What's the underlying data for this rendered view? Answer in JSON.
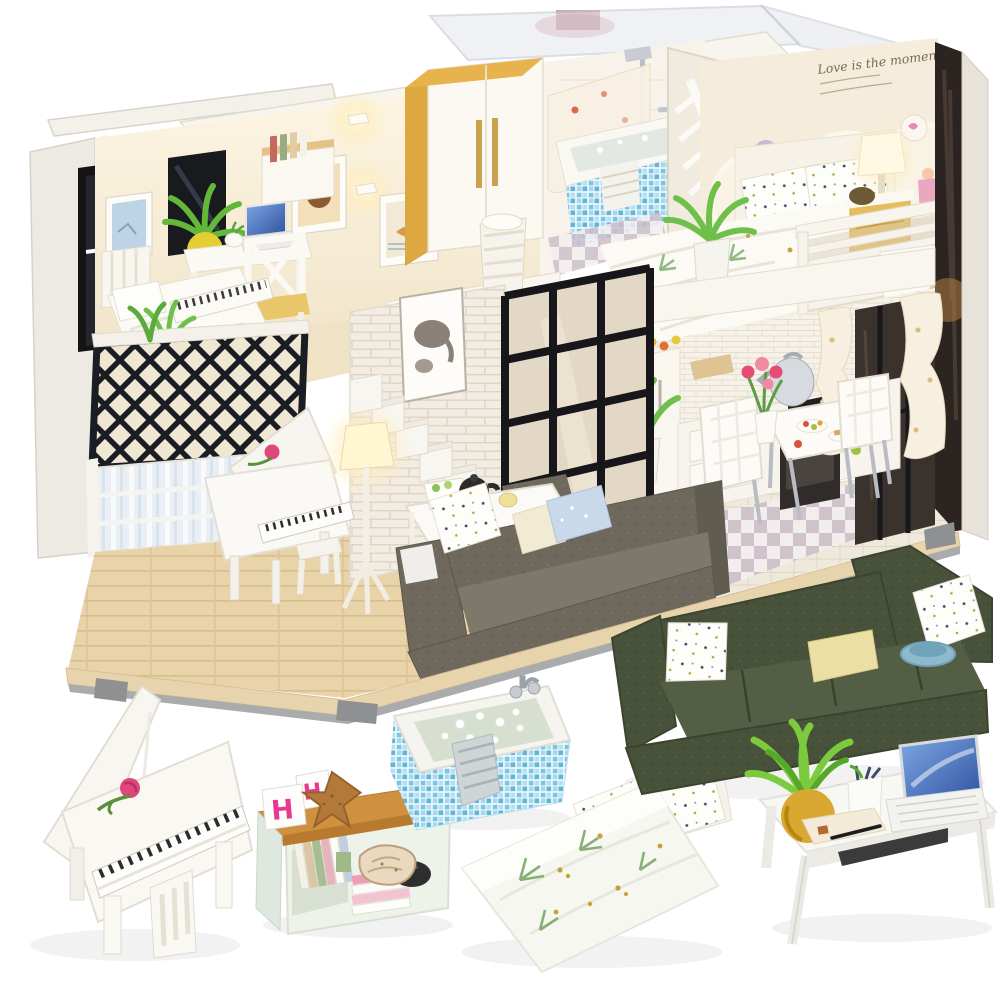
{
  "scene": {
    "type": "product photograph",
    "description": "DIY miniature dollhouse kit - modern two-storey loft with lit LED interior, shown with six close-up miniature furniture pieces on a white background",
    "background_color": "#ffffff"
  },
  "dollhouse": {
    "wall_decal_text": "Love is the moment",
    "style": "open-front modern loft with clear acrylic roof",
    "rooms": [
      {
        "name": "Study bedroom",
        "position": "upper left",
        "items": [
          "single bed",
          "desk with laptop",
          "cross-back chair with yellow seat",
          "wall shelf with books",
          "framed pictures",
          "aloe plant in yellow pot",
          "black lattice balcony railing"
        ]
      },
      {
        "name": "Bathroom",
        "position": "upper centre",
        "items": [
          "blue mosaic bathtub",
          "chrome shower set",
          "floral shower curtain",
          "white-and-gold wardrobe",
          "leaf cut-out screen",
          "towel basket"
        ]
      },
      {
        "name": "Master bedroom",
        "position": "upper right",
        "items": [
          "double bed with botanical duvet",
          "dotted pillows",
          "glowing bedside lamp",
          "yellow nightstand",
          "white slat balcony railing",
          "circle wallpaper with script decal",
          "potted plant"
        ]
      },
      {
        "name": "Living room",
        "position": "lower left",
        "items": [
          "white grand piano with pink rose",
          "glowing tripod floor lamp",
          "grey fabric corner sofa with cushions",
          "coffee table with black teapot and tea set",
          "white brick wall",
          "white staircase",
          "elephant art print",
          "striped panel wall"
        ]
      },
      {
        "name": "Kitchen and dining",
        "position": "lower right",
        "items": [
          "white cabinets and drawers",
          "black oven and hob",
          "silver kettle",
          "black-framed glass partition",
          "dining table with food plates",
          "two white dining chairs",
          "pink tulips in vase",
          "tied cream curtains",
          "checkerboard tiles"
        ]
      }
    ],
    "colors": {
      "cream_walls": "#f5ecd9",
      "wood_floor": "#e8d2a8",
      "white_brick": "#f2ece2",
      "black_frames": "#17181c",
      "mosaic_blue": "#7ac4e4",
      "warm_glow": "#ffedbb"
    }
  },
  "closeups": {
    "piano": {
      "label": "White grand piano with pink rose"
    },
    "bookshelf": {
      "label": "Shelf with books, starfish, conch shell and letter cubes",
      "letter_cubes": [
        "H",
        "H"
      ]
    },
    "bathtub": {
      "label": "Blue mosaic bathtub with bubbles, towel and chrome taps"
    },
    "bed": {
      "label": "Double bed with green botanical bedding and dotted pillows"
    },
    "sofa": {
      "label": "Dark green corner sofa with cushions and blue bowl"
    },
    "desk": {
      "label": "White desk with laptop, plant in mustard pot, pen cup and papers"
    }
  }
}
